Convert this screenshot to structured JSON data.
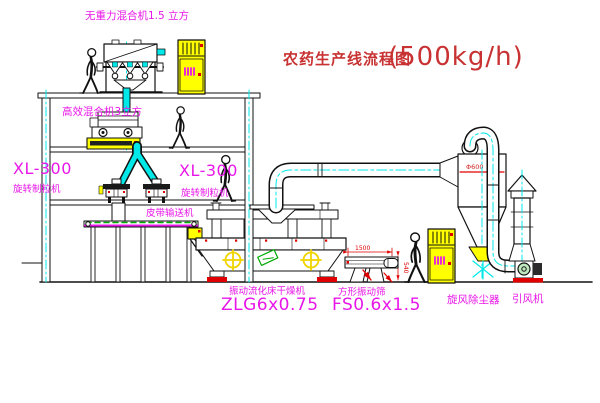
{
  "title": {
    "name": "农药生产线流程图",
    "capacity": "(500kg/h)"
  },
  "labels": {
    "roof_mixer": "无重力混合机1.5 立方",
    "floor2_mixer": "高效混合机3立方",
    "granulator_left_model": "XL-300",
    "granulator_left_name": "旋转制粒机",
    "granulator_right_model": "XL-300",
    "granulator_right_name": "旋转制粒机",
    "belt_conveyor": "皮带输送机",
    "dryer_name": "振动流化床干燥机",
    "dryer_model": "ZLG6x0.75",
    "screen_name": "方形振动筛",
    "screen_model": "FS0.6x1.5",
    "cyclone": "旋风除尘器",
    "fan": "引风机"
  },
  "dimensions": {
    "screen_width": "1500",
    "screen_height": "540",
    "cyclone_diameter": "Φ600"
  },
  "palette": {
    "line": "#111111",
    "cyan": "#00e8e8",
    "yellow": "#ffff00",
    "magenta": "#e816e8",
    "red": "#e00000",
    "title_red": "#c83232",
    "green": "#00aa00"
  }
}
